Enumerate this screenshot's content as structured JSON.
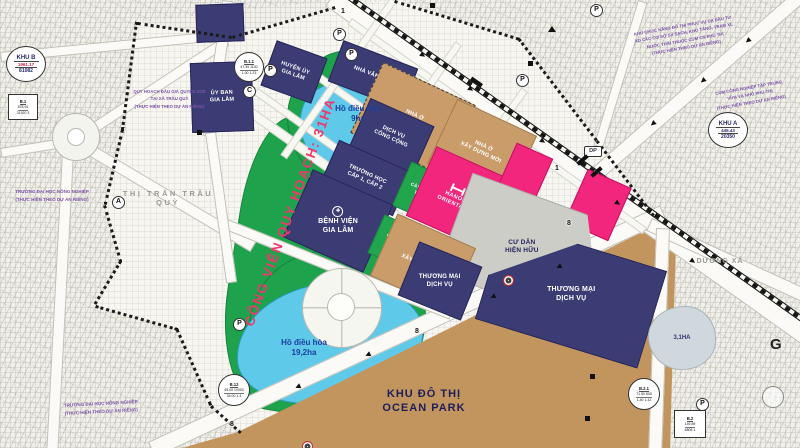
{
  "map": {
    "ovals": {
      "khu_b": {
        "name": "KHU B",
        "value1": "1961.17",
        "value2": "81082"
      },
      "khu_a": {
        "name": "KHU A",
        "value1": "445.43",
        "value2": "20350"
      }
    },
    "stat_labels": {
      "b1": {
        "id": "B.1",
        "row1": "878.91",
        "row2": "31920  3"
      },
      "b11": {
        "id": "B.1.1",
        "row1": "47.39  1100",
        "row2": "1.00  1.23"
      },
      "b12": {
        "id": "B.12",
        "row1": "45.00  10000",
        "row2": "34.00  1.4"
      },
      "b21": {
        "id": "B.2.1",
        "row1": "71.50  805",
        "row2": "1.40  1.42"
      },
      "b2": {
        "id": "B.2",
        "row1": "149.89",
        "row2": "6808  1"
      }
    },
    "zones": {
      "uy_ban": "ỦY BAN\nGIA LÂM",
      "huyen_uy": "HUYỆN ỦY\nGIA LÂM",
      "nha_van_hoa": "NHÀ VĂN HÓA",
      "dich_vu_cong_cong": "DỊCH VỤ\nCÔNG CỘNG",
      "truong_hoc": "TRƯỜNG HỌC\nCẤP 1, CẤP 2",
      "benh_vien": "BỆNH VIỆN\nGIA LÂM",
      "nha_o_xay_dung_moi": "NHÀ Ở\nXÂY DỰNG MỚI",
      "cay_xanh": "CÂY XANH\nTDTT",
      "hanoi_oriental": "HANOI\nORIENTAL",
      "cu_dan_hien_huu": "CƯ DÂN\nHIỆN HỮU",
      "thuong_mai_dich_vu": "THƯƠNG MẠI\nDỊCH VỤ",
      "ocean_park": "KHU ĐÔ THỊ\nOCEAN PARK",
      "cong_vien": "CÔNG VIÊN QUY HOẠCH: 31HA",
      "ho_dieu_hoa_9": "Hồ điều hòa\n9ha",
      "ho_dieu_hoa_19": "Hồ điều hòa\n19,2ha",
      "lake_3ha": "3,1HA",
      "thi_tran": "THỊ TRẤN TRÂU QUỲ",
      "duong_xa": "DƯƠNG XÁ"
    },
    "notes": {
      "dau_gia": "QUY HOẠCH ĐẤU GIÁ QUYỀN SDĐ\nTẠI XÃ TRÂU QUỲ\n(THỰC HIỆN THEO DỰ ÁN RIÊNG)",
      "dai_hoc_1": "TRƯỜNG ĐẠI HỌC NÔNG NGHIỆP\n(THỰC HIỆN THEO DỰ ÁN RIÊNG)",
      "dai_hoc_2": "TRƯỜNG ĐẠI HỌC NÔNG NGHIỆP\n(THỰC HIỆN THEO DỰ ÁN RIÊNG)",
      "khu_chuc_nang": "KHU CHỨC NĂNG ĐÔ THỊ PHỤC VỤ DA ĐẦU TƯ\nXD CÁC CƠ SỞ SX SẠCH, KHO TÀNG, TRẠM XL\nNƯỚC THẢI THUỘC CỤM CN PHÚ THỊ\n(THỰC HIỆN THEO DỰ ÁN RIÊNG)",
      "cum_cn": "CỤM CÔNG NGHIỆP TẬP TRUNG\nVỪA VÀ NHỎ PHÚ THỊ\n(THỰC HIỆN THEO DỰ ÁN RIÊNG)"
    },
    "badges": {
      "dp": "DP",
      "g": "G"
    },
    "colors": {
      "navy": "#3c3c74",
      "tan": "#c99c6a",
      "pink": "#f2267c",
      "green": "#1ea24b",
      "lake_blue": "#5fc9e9",
      "ocean_tan": "#c2955f",
      "park_label_red": "#ec3a6e"
    },
    "markers": {
      "parking": [
        {
          "x": 333,
          "y": 28
        },
        {
          "x": 345,
          "y": 48
        },
        {
          "x": 264,
          "y": 64
        },
        {
          "x": 516,
          "y": 74
        },
        {
          "x": 590,
          "y": 4
        },
        {
          "x": 233,
          "y": 318
        },
        {
          "x": 696,
          "y": 398
        }
      ],
      "letters": [
        {
          "t": "C",
          "x": 243,
          "y": 85
        },
        {
          "t": "A",
          "x": 112,
          "y": 196
        }
      ],
      "stations": [
        {
          "x": 503,
          "y": 275
        },
        {
          "x": 302,
          "y": 441
        }
      ],
      "rings": [
        {
          "x": 762,
          "y": 386
        }
      ],
      "road_numbers": [
        {
          "t": "1",
          "x": 341,
          "y": 8
        },
        {
          "t": "1",
          "x": 555,
          "y": 165
        },
        {
          "t": "8",
          "x": 567,
          "y": 220
        },
        {
          "t": "8",
          "x": 415,
          "y": 328
        },
        {
          "t": "8",
          "x": 230,
          "y": 421
        }
      ],
      "squares": [
        {
          "x": 197,
          "y": 130
        },
        {
          "x": 430,
          "y": 3
        },
        {
          "x": 528,
          "y": 61
        },
        {
          "x": 590,
          "y": 374
        },
        {
          "x": 585,
          "y": 416
        }
      ],
      "triangles": [
        {
          "x": 548,
          "y": 26
        }
      ],
      "arrows": [
        {
          "x": 420,
          "y": 52,
          "r": 35
        },
        {
          "x": 468,
          "y": 86,
          "r": 35
        },
        {
          "x": 540,
          "y": 138,
          "r": 35
        },
        {
          "x": 615,
          "y": 200,
          "r": 35
        },
        {
          "x": 690,
          "y": 258,
          "r": 35
        },
        {
          "x": 650,
          "y": 120,
          "r": 139
        },
        {
          "x": 700,
          "y": 77,
          "r": 139
        },
        {
          "x": 745,
          "y": 37,
          "r": 139
        },
        {
          "x": 295,
          "y": 383,
          "r": 155
        },
        {
          "x": 365,
          "y": 351,
          "r": 155
        },
        {
          "x": 490,
          "y": 293,
          "r": 155
        },
        {
          "x": 556,
          "y": 263,
          "r": 155
        }
      ],
      "bars": [
        {
          "x": 576,
          "y": 158,
          "r": -41
        },
        {
          "x": 590,
          "y": 170,
          "r": -41
        },
        {
          "x": 470,
          "y": 80,
          "r": 35
        }
      ]
    }
  }
}
